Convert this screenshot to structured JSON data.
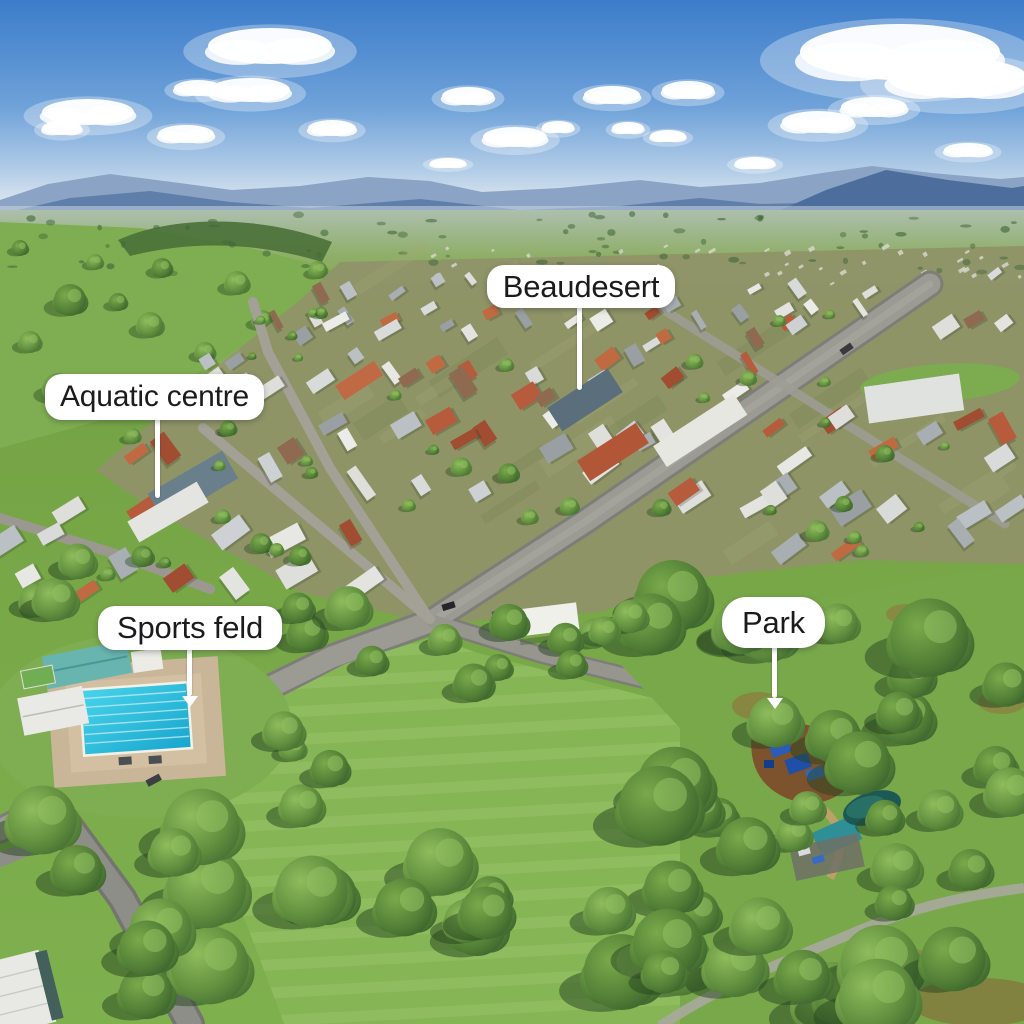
{
  "labels": {
    "town": "Beaudesert",
    "aquatic_centre": "Aquatic centre",
    "sports_field": "Sports feld",
    "park": "Park"
  },
  "colors": {
    "label_background": "#ffffff",
    "label_text": "#1b1b1d",
    "pointer_line": "#ffffff",
    "sky_blue": "#3b7cca",
    "mountain_blue": "#5d7da9",
    "grass_green": "#7fae4f",
    "pool_cyan": "#2fc0dd"
  }
}
